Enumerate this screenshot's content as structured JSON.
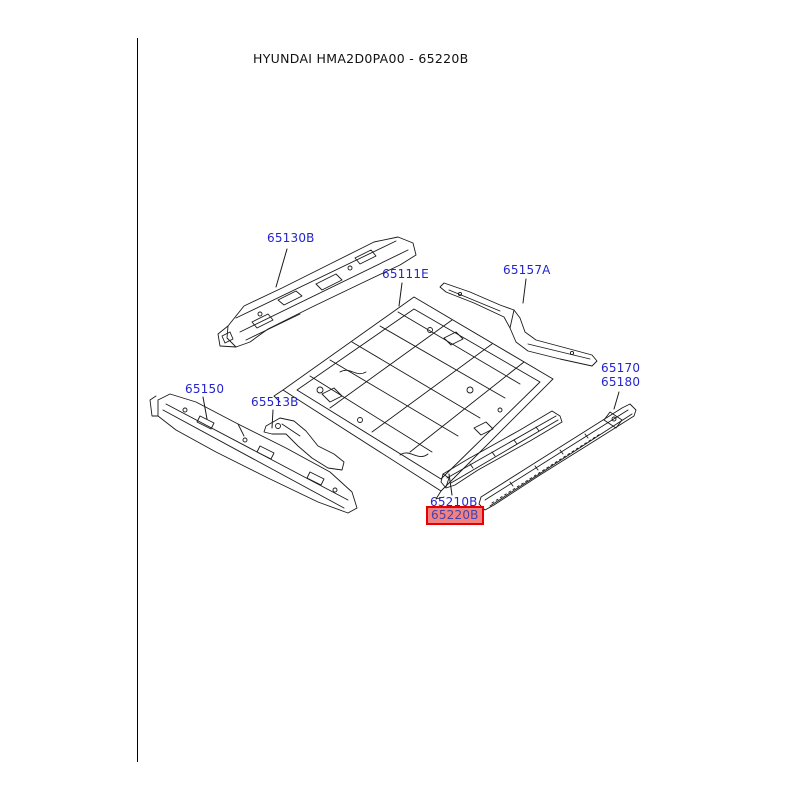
{
  "title": "HYUNDAI HMA2D0PA00 - 65220B",
  "diagram": {
    "colors": {
      "label_text": "#2525cd",
      "highlight_background": "#f28181",
      "highlight_border": "#e80000",
      "highlight_text": "#4543ae",
      "line_art": "#1a1a1a"
    },
    "labels": {
      "p65130b": {
        "text": "65130B"
      },
      "p65111e": {
        "text": "65111E"
      },
      "p65157a": {
        "text": "65157A"
      },
      "p65170": {
        "text": "65170"
      },
      "p65180": {
        "text": "65180"
      },
      "p65150": {
        "text": "65150"
      },
      "p65513b": {
        "text": "65513B"
      },
      "p65210b": {
        "text": "65210B"
      },
      "p65220b": {
        "text": "65220B"
      }
    }
  }
}
